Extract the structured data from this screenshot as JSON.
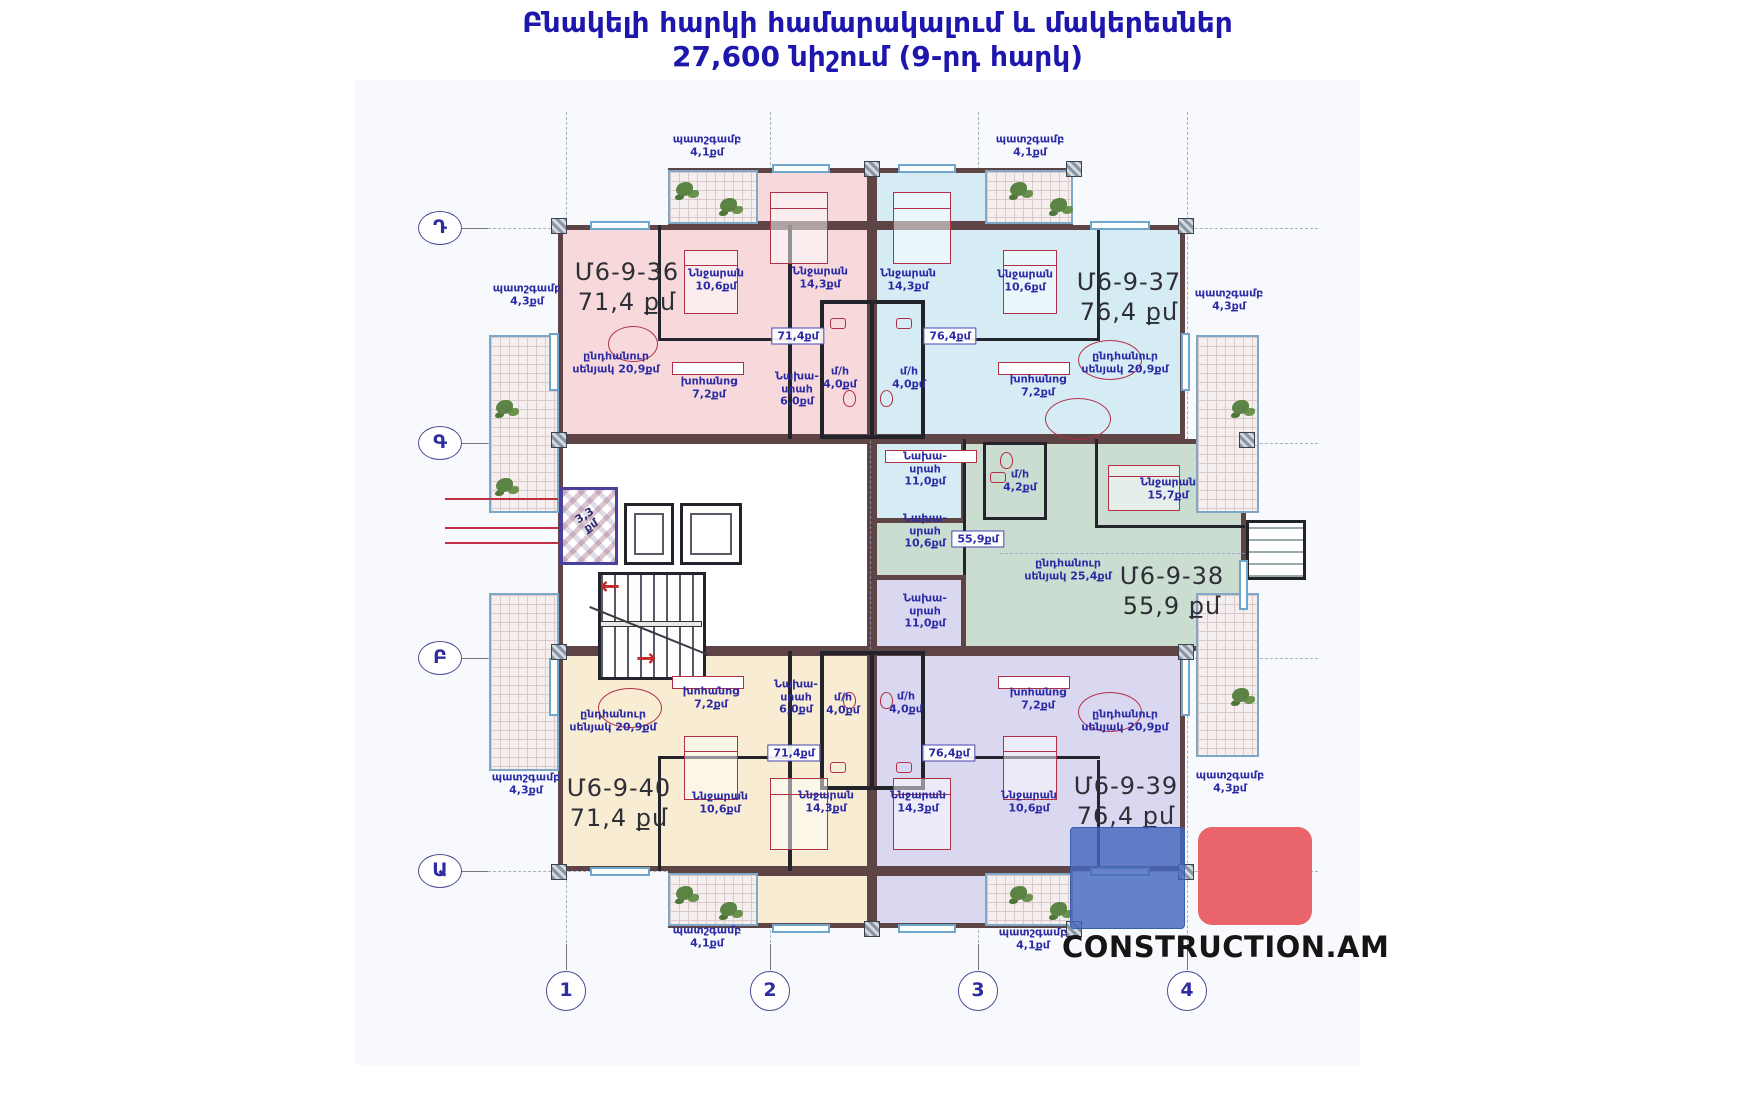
{
  "title": {
    "line1": "Բնակելի հարկի համարակալում և մակերեսներ",
    "line2": "27,600 նիշում (9-րդ հարկ)"
  },
  "watermark": "CONSTRUCTION.AM",
  "axes": {
    "rows": [
      "Դ",
      "Գ",
      "Բ",
      "Ա"
    ],
    "cols": [
      "1",
      "2",
      "3",
      "4"
    ]
  },
  "core": {
    "shaft": {
      "name": "3,3",
      "area": "քմ"
    }
  },
  "apartments": [
    {
      "id": "Մ6-9-36",
      "area_label": "71,4 քմ",
      "badge": "71,4քմ",
      "fill": "#f7d9dc",
      "rooms": [
        {
          "name": "Ննջարան",
          "area": "10,6քմ"
        },
        {
          "name": "Ննջարան",
          "area": "14,3քմ"
        },
        {
          "name": "ընդհանուր սենյակ",
          "area": "20,9քմ"
        },
        {
          "name": "խոհանոց",
          "area": "7,2քմ"
        },
        {
          "name": "Նախա-սրահ",
          "area": "6,0քմ"
        },
        {
          "name": "մ/հ",
          "area": "4,0քմ"
        }
      ]
    },
    {
      "id": "Մ6-9-37",
      "area_label": "76,4 քմ",
      "badge": "76,4քմ",
      "fill": "#d6ecf5",
      "rooms": [
        {
          "name": "Ննջարան",
          "area": "14,3քմ"
        },
        {
          "name": "Ննջարան",
          "area": "10,6քմ"
        },
        {
          "name": "ընդհանուր սենյակ",
          "area": "20,9քմ"
        },
        {
          "name": "խոհանոց",
          "area": "7,2քմ"
        },
        {
          "name": "Նախա-սրահ",
          "area": "11,0քմ"
        },
        {
          "name": "մ/հ",
          "area": "4,0քմ"
        }
      ]
    },
    {
      "id": "Մ6-9-38",
      "area_label": "55,9 քմ",
      "badge": "55,9քմ",
      "fill": "#cbdcd1",
      "rooms": [
        {
          "name": "Ննջարան",
          "area": "15,7քմ"
        },
        {
          "name": "ընդհանուր սենյակ",
          "area": "25,4քմ"
        },
        {
          "name": "Նախա-սրահ",
          "area": "10,6քմ"
        },
        {
          "name": "մ/հ",
          "area": "4,2քմ"
        }
      ]
    },
    {
      "id": "Մ6-9-39",
      "area_label": "76,4 քմ",
      "badge": "76,4քմ",
      "fill": "#dad7f0",
      "rooms": [
        {
          "name": "Ննջարան",
          "area": "10,6քմ"
        },
        {
          "name": "Ննջարան",
          "area": "14,3քմ"
        },
        {
          "name": "ընդհանուր սենյակ",
          "area": "20,9քմ"
        },
        {
          "name": "խոհանոց",
          "area": "7,2քմ"
        },
        {
          "name": "Նախա-սրահ",
          "area": "11,0քմ"
        },
        {
          "name": "մ/հ",
          "area": "4,0քմ"
        }
      ]
    },
    {
      "id": "Մ6-9-40",
      "area_label": "71,4 քմ",
      "badge": "71,4քմ",
      "fill": "#f8ecd2",
      "rooms": [
        {
          "name": "Ննջարան",
          "area": "10,6քմ"
        },
        {
          "name": "Ննջարան",
          "area": "14,3քմ"
        },
        {
          "name": "ընդհանուր սենյակ",
          "area": "20,9քմ"
        },
        {
          "name": "խոհանոց",
          "area": "7,2քմ"
        },
        {
          "name": "Նախա-սրահ",
          "area": "6,0քմ"
        },
        {
          "name": "մ/հ",
          "area": "4,0քմ"
        }
      ]
    }
  ],
  "balconies": [
    {
      "name": "պատշգամբ",
      "area": "4,1քմ"
    },
    {
      "name": "պատշգամբ",
      "area": "4,1քմ"
    },
    {
      "name": "պատշգամբ",
      "area": "4,1քմ"
    },
    {
      "name": "պատշգամբ",
      "area": "4,1քմ"
    },
    {
      "name": "պատշգամբ",
      "area": "4,3քմ"
    },
    {
      "name": "պատշգամբ",
      "area": "4,3քմ"
    },
    {
      "name": "պատշգամբ",
      "area": "4,3քմ"
    },
    {
      "name": "պատշգամբ",
      "area": "4,3քմ"
    }
  ],
  "colors": {
    "wall": "#5e4444",
    "label": "#2b2ba6",
    "title": "#1d17ad",
    "logo_blue": "#4468bc",
    "logo_red": "#ea656b"
  }
}
